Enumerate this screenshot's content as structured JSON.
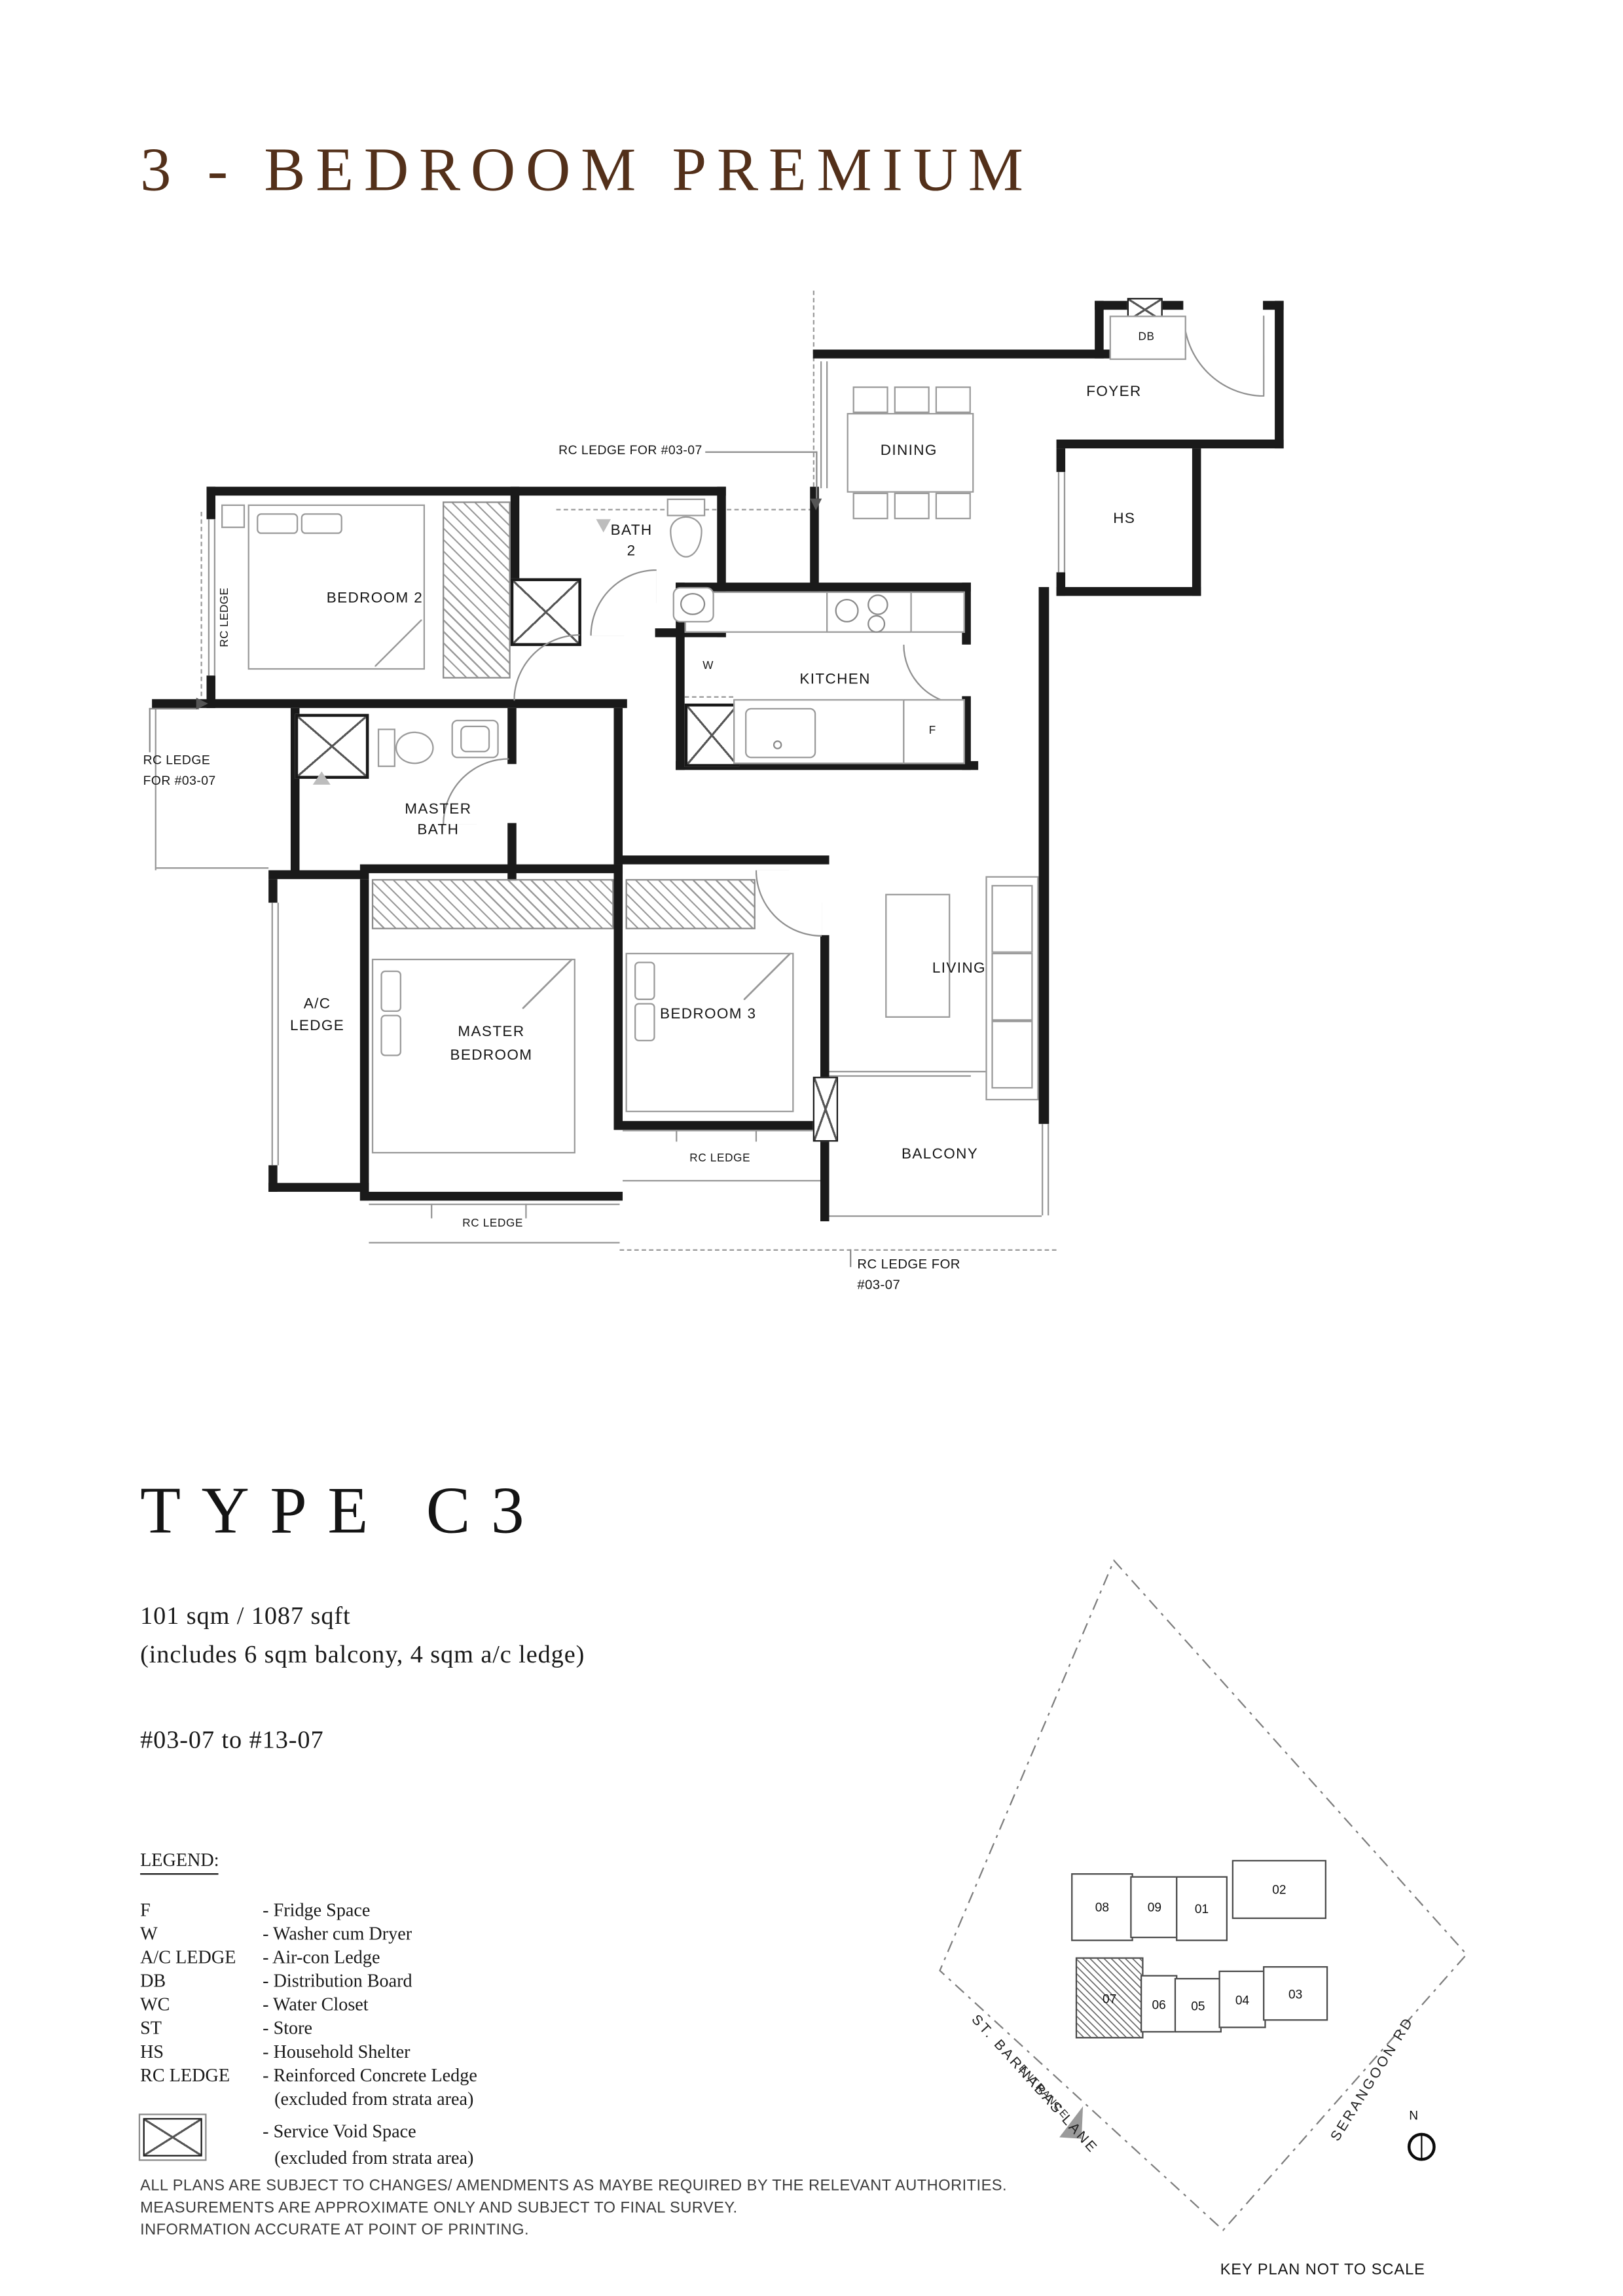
{
  "colors": {
    "accent_brown": "#53301a",
    "wall": "#1a1a1a",
    "thin_line": "#8a8a8a"
  },
  "title": "3 - BEDROOM PREMIUM",
  "plan": {
    "rooms": {
      "foyer": "FOYER",
      "dining": "DINING",
      "kitchen": "KITCHEN",
      "household_shelter": "HS",
      "db": "DB",
      "washer": "W",
      "fridge": "F",
      "bath2_line1": "BATH",
      "bath2_line2": "2",
      "bedroom2": "BEDROOM 2",
      "master_bath_line1": "MASTER",
      "master_bath_line2": "BATH",
      "ac_ledge_line1": "A/C",
      "ac_ledge_line2": "LEDGE",
      "master_bedroom_line1": "MASTER",
      "master_bedroom_line2": "BEDROOM",
      "bedroom3": "BEDROOM 3",
      "living": "LIVING",
      "balcony": "BALCONY"
    },
    "annotations": {
      "rc_ledge_top": "RC LEDGE FOR #03-07",
      "rc_ledge_left_line1": "RC LEDGE",
      "rc_ledge_left_line2": "FOR #03-07",
      "rc_ledge_vertical": "RC LEDGE",
      "rc_ledge_mbr": "RC LEDGE",
      "rc_ledge_b3": "RC LEDGE",
      "rc_ledge_bottom_line1": "RC LEDGE FOR",
      "rc_ledge_bottom_line2": "#03-07"
    }
  },
  "type_block": {
    "type_name": "TYPE C3",
    "area": "101 sqm / 1087 sqft",
    "area_note": "(includes 6 sqm balcony, 4 sqm a/c ledge)",
    "unit_range": "#03-07 to #13-07"
  },
  "legend": {
    "heading": "LEGEND:",
    "items": [
      {
        "abbr": "F",
        "desc": "- Fridge Space"
      },
      {
        "abbr": "W",
        "desc": "- Washer cum Dryer"
      },
      {
        "abbr": "A/C LEDGE",
        "desc": "- Air-con Ledge"
      },
      {
        "abbr": "DB",
        "desc": "- Distribution Board"
      },
      {
        "abbr": "WC",
        "desc": "- Water Closet"
      },
      {
        "abbr": "ST",
        "desc": "- Store"
      },
      {
        "abbr": "HS",
        "desc": "- Household Shelter"
      },
      {
        "abbr": "RC LEDGE",
        "desc": "- Reinforced Concrete Ledge",
        "desc2": "(excluded from strata area)"
      },
      {
        "abbr": "",
        "desc": "- Service Void Space",
        "desc2": "(excluded from strata area)",
        "icon": "service-void-icon"
      }
    ]
  },
  "key_plan": {
    "units": [
      "08",
      "09",
      "01",
      "02",
      "07",
      "06",
      "05",
      "04",
      "03"
    ],
    "highlighted_unit": "07",
    "road_left": "ST. BARNABAS LANE",
    "road_right": "SERANGOON RD",
    "entrance": "ENTRANCE",
    "note": "KEY PLAN NOT TO SCALE",
    "north": "N"
  },
  "disclaimer": {
    "line1": "ALL PLANS ARE SUBJECT TO CHANGES/ AMENDMENTS AS MAYBE REQUIRED BY THE RELEVANT AUTHORITIES.",
    "line2": "MEASUREMENTS ARE APPROXIMATE ONLY AND SUBJECT TO FINAL SURVEY.",
    "line3": "INFORMATION ACCURATE AT POINT OF PRINTING."
  }
}
